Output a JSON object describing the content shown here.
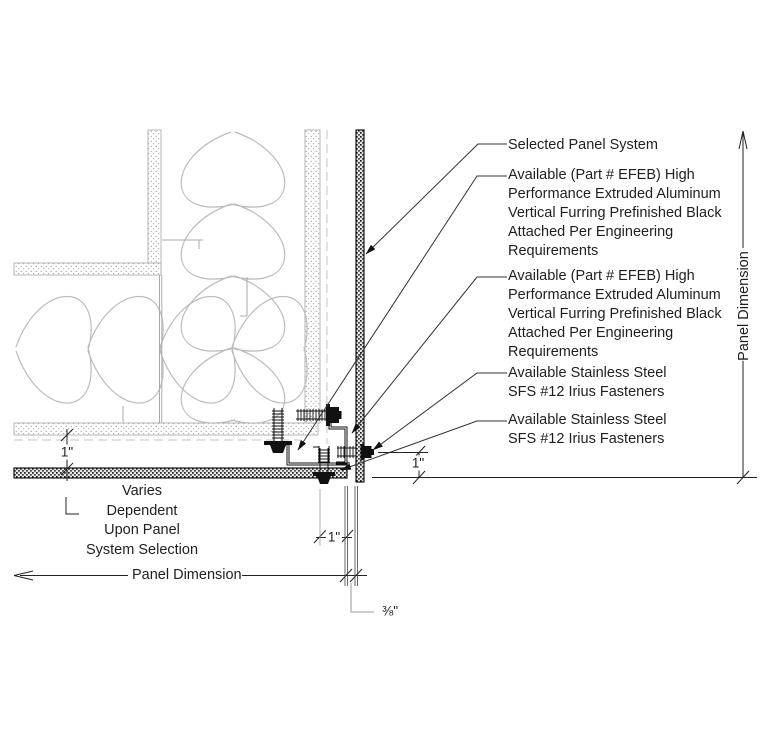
{
  "drawing": {
    "title_hint": "Panel system outside-corner detail",
    "callouts": {
      "selected_panel": "Selected Panel System",
      "furring_note_1": "Available (Part # EFEB) High\nPerformance Extruded Aluminum\nVertical Furring Prefinished Black\nAttached Per Engineering\nRequirements",
      "furring_note_2": "Available (Part # EFEB) High\nPerformance Extruded Aluminum\nVertical Furring Prefinished Black\nAttached Per Engineering\nRequirements",
      "fastener_note_1": "Available Stainless Steel\nSFS #12 Irius Fasteners",
      "fastener_note_2": "Available Stainless Steel\nSFS #12 Irius Fasteners",
      "varies_note": "Varies\nDependent\nUpon Panel\nSystem Selection"
    },
    "dimensions": {
      "panel_dimension_bottom": "Panel Dimension",
      "panel_dimension_right": "Panel Dimension",
      "gap_left": "1\"",
      "gap_right": "1\"",
      "gap_bottom": "1\"",
      "joint": "⅜\""
    },
    "colors": {
      "line": "#1a1a1a",
      "light_line": "#bcbcbc",
      "stipple": "#9a9a9a"
    }
  }
}
